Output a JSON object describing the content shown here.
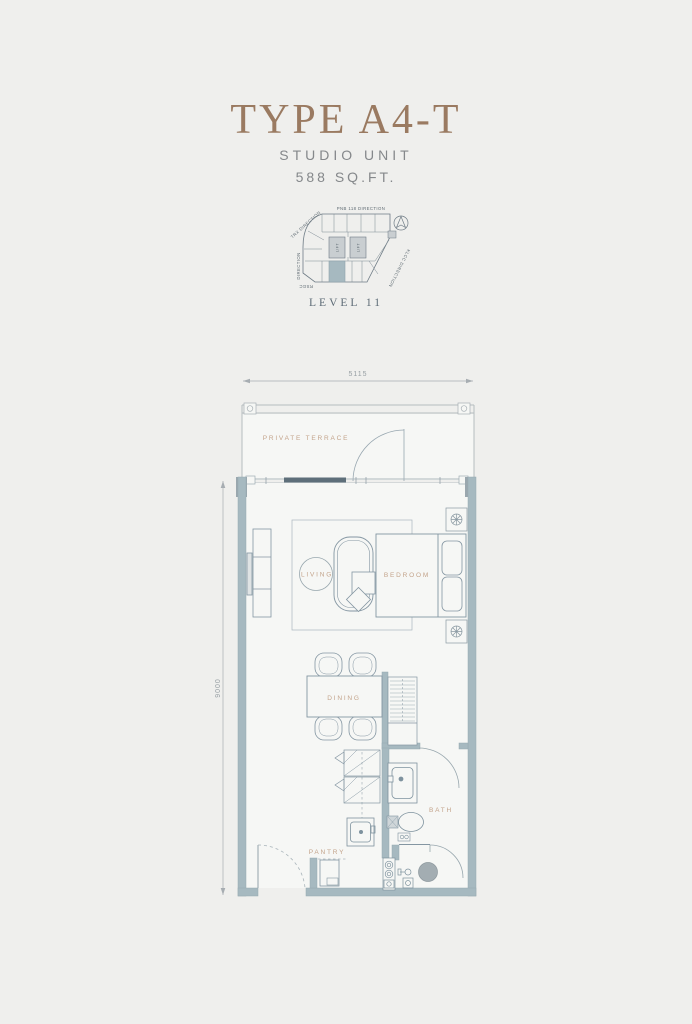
{
  "header": {
    "title": "TYPE A4-T",
    "subtitle": "STUDIO UNIT",
    "area": "588 SQ.FT.",
    "level": "LEVEL 11"
  },
  "key_plan": {
    "label_top": "PNB 118 DIRECTION",
    "label_top_left": "TRX DIRECTION",
    "label_left": "DIRECTION",
    "label_bottom_left": "RSGC",
    "label_bottom_right": "KLCC DIRECTION",
    "lift_label": "LIFT",
    "highlight_color": "#a6b9c0"
  },
  "floor_plan": {
    "dimension_width": "5115",
    "dimension_height": "9000",
    "rooms": {
      "terrace": "PRIVATE TERRACE",
      "living": "LIVING",
      "bedroom": "BEDROOM",
      "dining": "DINING",
      "pantry": "PANTRY",
      "bath": "BATH"
    },
    "colors": {
      "wall": "#a6b9c0",
      "column": "#9aa7ae",
      "furniture_line": "#8496a2",
      "label": "#c3a38a",
      "title_accent": "#9a7a61"
    }
  }
}
